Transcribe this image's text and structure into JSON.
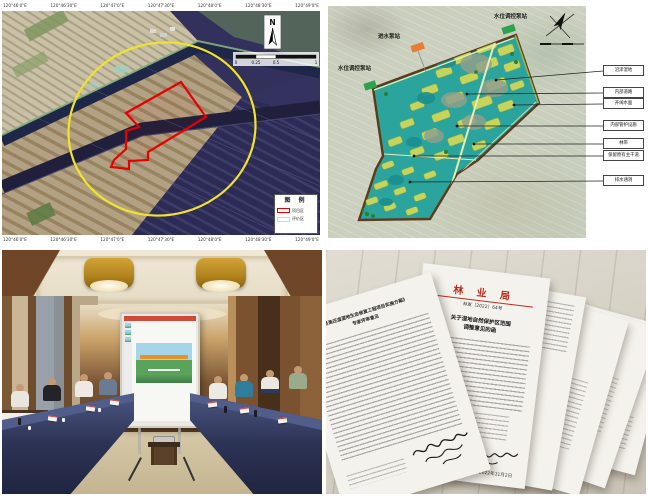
{
  "panels": {
    "map": {
      "coords_top": [
        "120°46'0\"E",
        "120°46'30\"E",
        "120°47'0\"E",
        "120°47'30\"E",
        "120°48'0\"E",
        "120°48'30\"E",
        "120°49'0\"E"
      ],
      "coords_bottom": [
        "120°46'0\"E",
        "120°46'30\"E",
        "120°47'0\"E",
        "120°47'30\"E",
        "120°48'0\"E",
        "120°48'30\"E",
        "120°49'0\"E"
      ],
      "north_label": "N",
      "scale_labels": [
        "0",
        "0.25",
        "0.5",
        "1"
      ],
      "legend": {
        "title": "图 例",
        "items": [
          {
            "label": "项目区",
            "color": "#e60000"
          },
          {
            "label": "评价区",
            "color": "#f0e32c"
          }
        ]
      }
    },
    "plan": {
      "pump_labels": [
        {
          "text": "进水泵站",
          "color": "#e77c35"
        },
        {
          "text": "水位调控泵站",
          "color": "#2ca24b"
        },
        {
          "text": "水位调控泵站",
          "color": "#2ca24b"
        }
      ],
      "callouts": [
        "沼泽湿地",
        "内部道路",
        "开阔水面",
        "内部管护设施",
        "林带",
        "保留原有主干道",
        "排水涵洞"
      ]
    },
    "docs": {
      "letterhead": "林 业 局",
      "doc_number": "林发〔2022〕64号",
      "title_lines": [
        "关于湿地自然保护区范围",
        "调整意见的函"
      ],
      "left_title_lines": [
        "《退渔还湿湿地生态修复工程项目实施方案》",
        "专家评审意见"
      ],
      "side_header": "自然资源和规划局",
      "date": "2022年11月2日"
    }
  }
}
